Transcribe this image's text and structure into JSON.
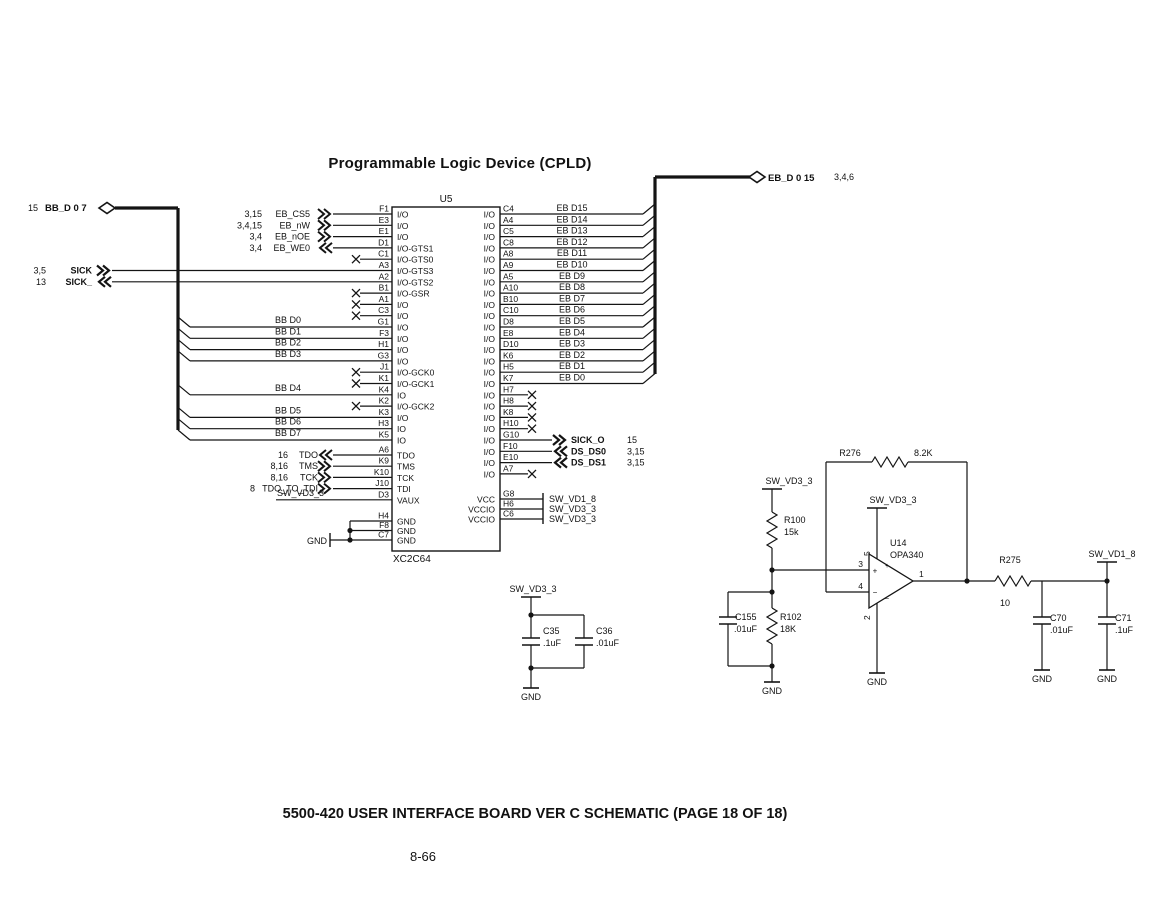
{
  "page": {
    "title": "Programmable Logic Device (CPLD)",
    "footer_title": "5500-420 USER INTERFACE BOARD VER C SCHEMATIC (PAGE 18 OF 18)",
    "page_number": "8-66"
  },
  "colors": {
    "ink": "#141414",
    "bg": "#ffffff"
  },
  "left_bus": {
    "refs": "15",
    "label": "BB_D 0 7"
  },
  "right_bus": {
    "label": "EB_D 0 15",
    "refs": "3,4,6"
  },
  "cpld": {
    "refdes": "U5",
    "part": "XC2C64",
    "left_pins": [
      {
        "pin": "F1",
        "fn": "I/O",
        "conn": "chev",
        "dir": "right",
        "signal": "EB_CS5",
        "refs": "3,15"
      },
      {
        "pin": "E3",
        "fn": "I/O",
        "conn": "chev",
        "dir": "right",
        "signal": "EB_nW",
        "refs": "3,4,15"
      },
      {
        "pin": "E1",
        "fn": "I/O",
        "conn": "chev",
        "dir": "right",
        "signal": "EB_nOE",
        "refs": "3,4"
      },
      {
        "pin": "D1",
        "fn": "I/O-GTS1",
        "conn": "chev",
        "dir": "left",
        "signal": "EB_WE0",
        "refs": "3,4"
      },
      {
        "pin": "C1",
        "fn": "I/O-GTS0",
        "conn": "nc"
      },
      {
        "pin": "A3",
        "fn": "I/O-GTS3",
        "conn": "sick",
        "dir": "right",
        "signal": "SICK",
        "refs": "3,5"
      },
      {
        "pin": "A2",
        "fn": "I/O-GTS2",
        "conn": "sick",
        "dir": "left",
        "signal": "SICK_",
        "refs": "13"
      },
      {
        "pin": "B1",
        "fn": "I/O-GSR",
        "conn": "nc"
      },
      {
        "pin": "A1",
        "fn": "I/O",
        "conn": "nc"
      },
      {
        "pin": "C3",
        "fn": "I/O",
        "conn": "nc"
      },
      {
        "pin": "G1",
        "fn": "I/O",
        "conn": "bus",
        "signal": "BB D0"
      },
      {
        "pin": "F3",
        "fn": "I/O",
        "conn": "bus",
        "signal": "BB D1"
      },
      {
        "pin": "H1",
        "fn": "I/O",
        "conn": "bus",
        "signal": "BB D2"
      },
      {
        "pin": "G3",
        "fn": "I/O",
        "conn": "bus",
        "signal": "BB D3"
      },
      {
        "pin": "J1",
        "fn": "I/O-GCK0",
        "conn": "nc"
      },
      {
        "pin": "K1",
        "fn": "I/O-GCK1",
        "conn": "nc"
      },
      {
        "pin": "K4",
        "fn": "IO",
        "conn": "bus",
        "signal": "BB D4"
      },
      {
        "pin": "K2",
        "fn": "I/O-GCK2",
        "conn": "nc"
      },
      {
        "pin": "K3",
        "fn": "I/O",
        "conn": "bus",
        "signal": "BB D5"
      },
      {
        "pin": "H3",
        "fn": "IO",
        "conn": "bus",
        "signal": "BB D6"
      },
      {
        "pin": "K5",
        "fn": "IO",
        "conn": "bus",
        "signal": "BB D7"
      },
      {
        "pin": "A6",
        "fn": "TDO",
        "conn": "chev",
        "dir": "left",
        "signal": "TDO",
        "refs": "16"
      },
      {
        "pin": "K9",
        "fn": "TMS",
        "conn": "chev",
        "dir": "right",
        "signal": "TMS",
        "refs": "8,16"
      },
      {
        "pin": "K10",
        "fn": "TCK",
        "conn": "chev",
        "dir": "right",
        "signal": "TCK",
        "refs": "8,16"
      },
      {
        "pin": "J10",
        "fn": "TDI",
        "conn": "chev",
        "dir": "right",
        "signal": "TDO_TO_TDI",
        "refs": "8"
      },
      {
        "pin": "D3",
        "fn": "VAUX",
        "conn": "net",
        "signal": "SW_VD3_3"
      },
      {
        "pin": "H4",
        "fn": "GND",
        "conn": "gnd"
      },
      {
        "pin": "F8",
        "fn": "GND",
        "conn": "gnd"
      },
      {
        "pin": "C7",
        "fn": "GND",
        "conn": "gnd"
      }
    ],
    "right_pins": [
      {
        "pin": "C4",
        "fn": "I/O",
        "conn": "bus",
        "signal": "EB D15"
      },
      {
        "pin": "A4",
        "fn": "I/O",
        "conn": "bus",
        "signal": "EB D14"
      },
      {
        "pin": "C5",
        "fn": "I/O",
        "conn": "bus",
        "signal": "EB D13"
      },
      {
        "pin": "C8",
        "fn": "I/O",
        "conn": "bus",
        "signal": "EB D12"
      },
      {
        "pin": "A8",
        "fn": "I/O",
        "conn": "bus",
        "signal": "EB D11"
      },
      {
        "pin": "A9",
        "fn": "I/O",
        "conn": "bus",
        "signal": "EB D10"
      },
      {
        "pin": "A5",
        "fn": "I/O",
        "conn": "bus",
        "signal": "EB D9"
      },
      {
        "pin": "A10",
        "fn": "I/O",
        "conn": "bus",
        "signal": "EB D8"
      },
      {
        "pin": "B10",
        "fn": "I/O",
        "conn": "bus",
        "signal": "EB D7"
      },
      {
        "pin": "C10",
        "fn": "I/O",
        "conn": "bus",
        "signal": "EB D6"
      },
      {
        "pin": "D8",
        "fn": "I/O",
        "conn": "bus",
        "signal": "EB D5"
      },
      {
        "pin": "E8",
        "fn": "I/O",
        "conn": "bus",
        "signal": "EB D4"
      },
      {
        "pin": "D10",
        "fn": "I/O",
        "conn": "bus",
        "signal": "EB D3"
      },
      {
        "pin": "K6",
        "fn": "I/O",
        "conn": "bus",
        "signal": "EB D2"
      },
      {
        "pin": "H5",
        "fn": "I/O",
        "conn": "bus",
        "signal": "EB D1"
      },
      {
        "pin": "K7",
        "fn": "I/O",
        "conn": "bus",
        "signal": "EB D0"
      },
      {
        "pin": "H7",
        "fn": "I/O",
        "conn": "nc"
      },
      {
        "pin": "H8",
        "fn": "I/O",
        "conn": "nc"
      },
      {
        "pin": "K8",
        "fn": "I/O",
        "conn": "nc"
      },
      {
        "pin": "H10",
        "fn": "I/O",
        "conn": "nc"
      },
      {
        "pin": "G10",
        "fn": "I/O",
        "conn": "chev",
        "dir": "right",
        "signal": "SICK_O",
        "refs": "15",
        "bold": true
      },
      {
        "pin": "F10",
        "fn": "I/O",
        "conn": "chev",
        "dir": "left",
        "signal": "DS_DS0",
        "refs": "3,15",
        "bold": true
      },
      {
        "pin": "E10",
        "fn": "I/O",
        "conn": "chev",
        "dir": "left",
        "signal": "DS_DS1",
        "refs": "3,15",
        "bold": true
      },
      {
        "pin": "A7",
        "fn": "I/O",
        "conn": "nc"
      }
    ],
    "power_pins": [
      {
        "pin": "G8",
        "fn": "VCC",
        "net": "SW_VD1_8"
      },
      {
        "pin": "H6",
        "fn": "VCCIO",
        "net": "SW_VD3_3"
      },
      {
        "pin": "C6",
        "fn": "VCCIO",
        "net": "SW_VD3_3"
      }
    ],
    "gnd_net": "GND"
  },
  "decoupling": {
    "net": "SW_VD3_3",
    "c35": {
      "ref": "C35",
      "value": ".1uF"
    },
    "c36": {
      "ref": "C36",
      "value": ".01uF"
    },
    "gnd": "GND"
  },
  "analog": {
    "opamp": {
      "refdes": "U14",
      "part": "OPA340",
      "pin_out": "1",
      "pin_gnd": "2",
      "pin_plus": "3",
      "pin_minus": "4",
      "pin_vcc": "5"
    },
    "r276": {
      "ref": "R276",
      "value": "8.2K"
    },
    "r100": {
      "ref": "R100",
      "value": "15k"
    },
    "r102": {
      "ref": "R102",
      "value": "18K"
    },
    "c155": {
      "ref": "C155",
      "value": ".01uF"
    },
    "r275": {
      "ref": "R275",
      "value": "10"
    },
    "c70": {
      "ref": "C70",
      "value": ".01uF"
    },
    "c71": {
      "ref": "C71",
      "value": ".1uF"
    },
    "net_vd33": "SW_VD3_3",
    "net_vd18": "SW_VD1_8",
    "gnd": "GND"
  }
}
